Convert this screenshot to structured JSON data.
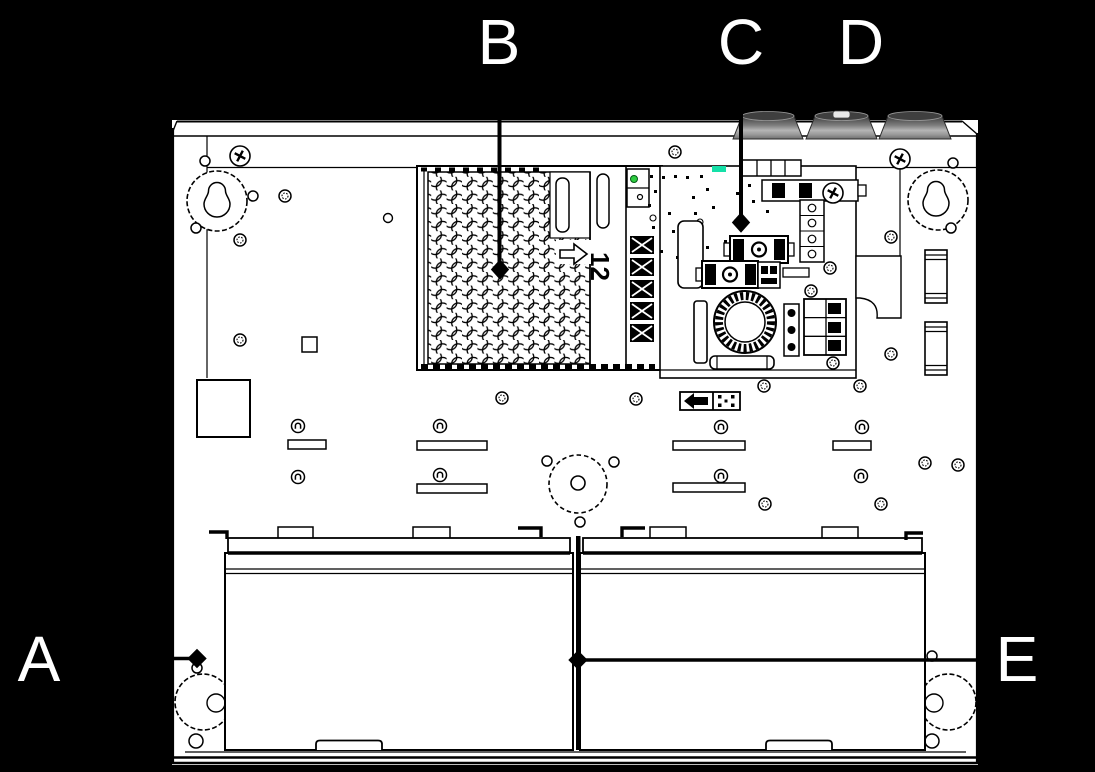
{
  "callouts": {
    "a": "A",
    "b": "B",
    "c": "C",
    "d": "D",
    "e": "E"
  },
  "psu": {
    "voltage_label": "12"
  },
  "colors": {
    "background": "#000000",
    "panel": "#ffffff",
    "line": "#000000",
    "knockout_gray": "#8f8f8f",
    "led_green": "#2ecc40",
    "pcb_mark_teal": "#15e0a8"
  }
}
